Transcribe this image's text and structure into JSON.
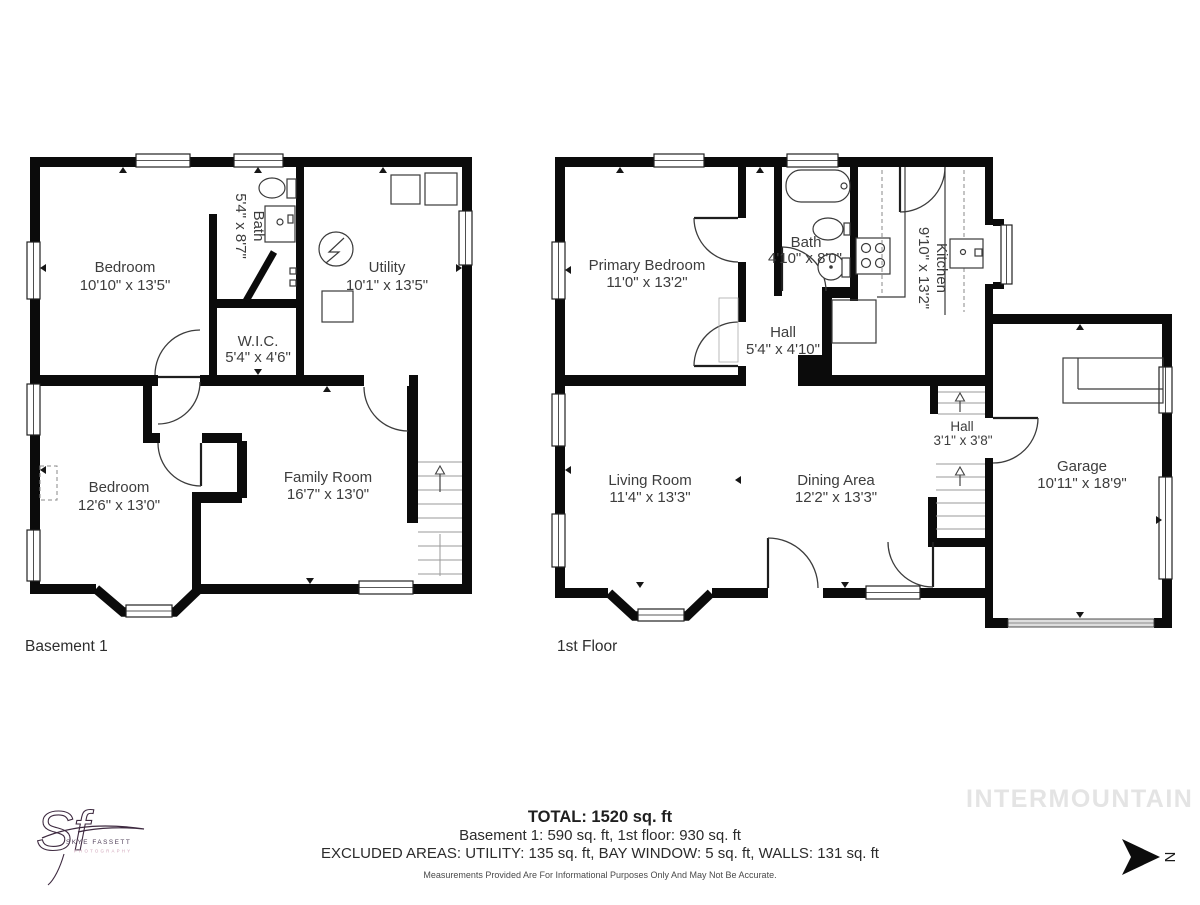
{
  "plans": {
    "basement": {
      "floor_label": "Basement 1",
      "rooms": {
        "bedroom1": {
          "name": "Bedroom",
          "dims": "10'10\" x 13'5\""
        },
        "bath": {
          "name": "Bath",
          "dims": "5'4\" x 8'7\""
        },
        "utility": {
          "name": "Utility",
          "dims": "10'1\" x 13'5\""
        },
        "wic": {
          "name": "W.I.C.",
          "dims": "5'4\" x 4'6\""
        },
        "bedroom2": {
          "name": "Bedroom",
          "dims": "12'6\" x 13'0\""
        },
        "family": {
          "name": "Family Room",
          "dims": "16'7\" x 13'0\""
        }
      }
    },
    "first": {
      "floor_label": "1st Floor",
      "rooms": {
        "primary": {
          "name": "Primary Bedroom",
          "dims": "11'0\" x 13'2\""
        },
        "bath": {
          "name": "Bath",
          "dims": "4'10\" x 8'0\""
        },
        "kitchen": {
          "name": "Kitchen",
          "dims": "9'10\" x 13'2\""
        },
        "hall": {
          "name": "Hall",
          "dims": "5'4\" x 4'10\""
        },
        "living": {
          "name": "Living Room",
          "dims": "11'4\" x 13'3\""
        },
        "dining": {
          "name": "Dining Area",
          "dims": "12'2\" x 13'3\""
        },
        "stairhall": {
          "name": "Hall",
          "dims": "3'1\" x 3'8\""
        },
        "garage": {
          "name": "Garage",
          "dims": "10'11\" x 18'9\""
        }
      }
    }
  },
  "summary": {
    "total": "TOTAL: 1520 sq. ft",
    "floors": "Basement 1: 590 sq. ft, 1st floor: 930 sq. ft",
    "excluded": "EXCLUDED AREAS: UTILITY: 135 sq. ft, BAY WINDOW: 5 sq. ft, WALLS: 131 sq. ft",
    "disclaimer": "Measurements Provided Are For Informational Purposes Only And May Not Be Accurate."
  },
  "branding": {
    "watermark": "INTERMOUNTAIN",
    "logo_monogram": "Sf",
    "logo_name": "SKYE FASSETT",
    "logo_subtitle": "PHOTOGRAPHY"
  },
  "compass": {
    "label": "N"
  },
  "colors": {
    "wall": "#0b0b0b",
    "label_text": "#3d3d3d",
    "watermark": "#e4e4e4",
    "logo": "#3e2a40",
    "logo_subtitle": "#cfa3b8"
  }
}
